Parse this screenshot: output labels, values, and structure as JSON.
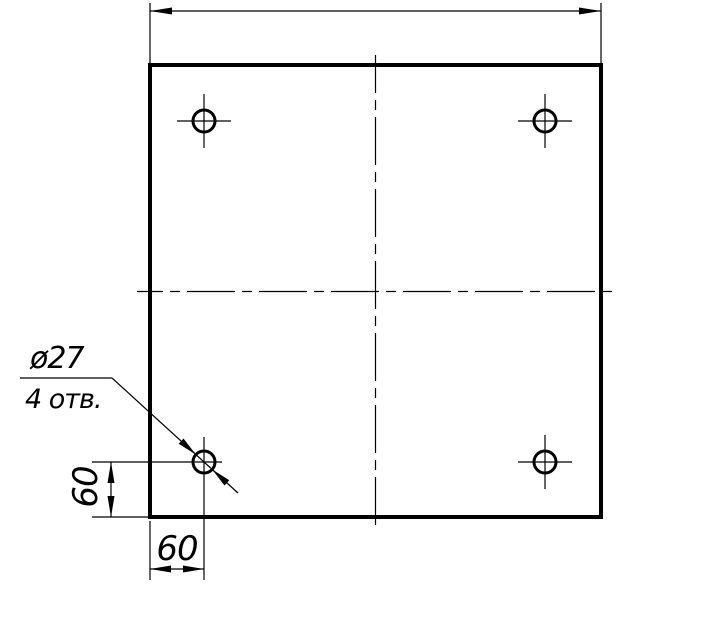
{
  "colors": {
    "ink": "#000000",
    "paper": "#ffffff"
  },
  "leader": {
    "diameter_label": "ø27",
    "count_label": "4 отв."
  },
  "dimensions": {
    "left_vertical": "60",
    "bottom_horizontal": "60"
  }
}
